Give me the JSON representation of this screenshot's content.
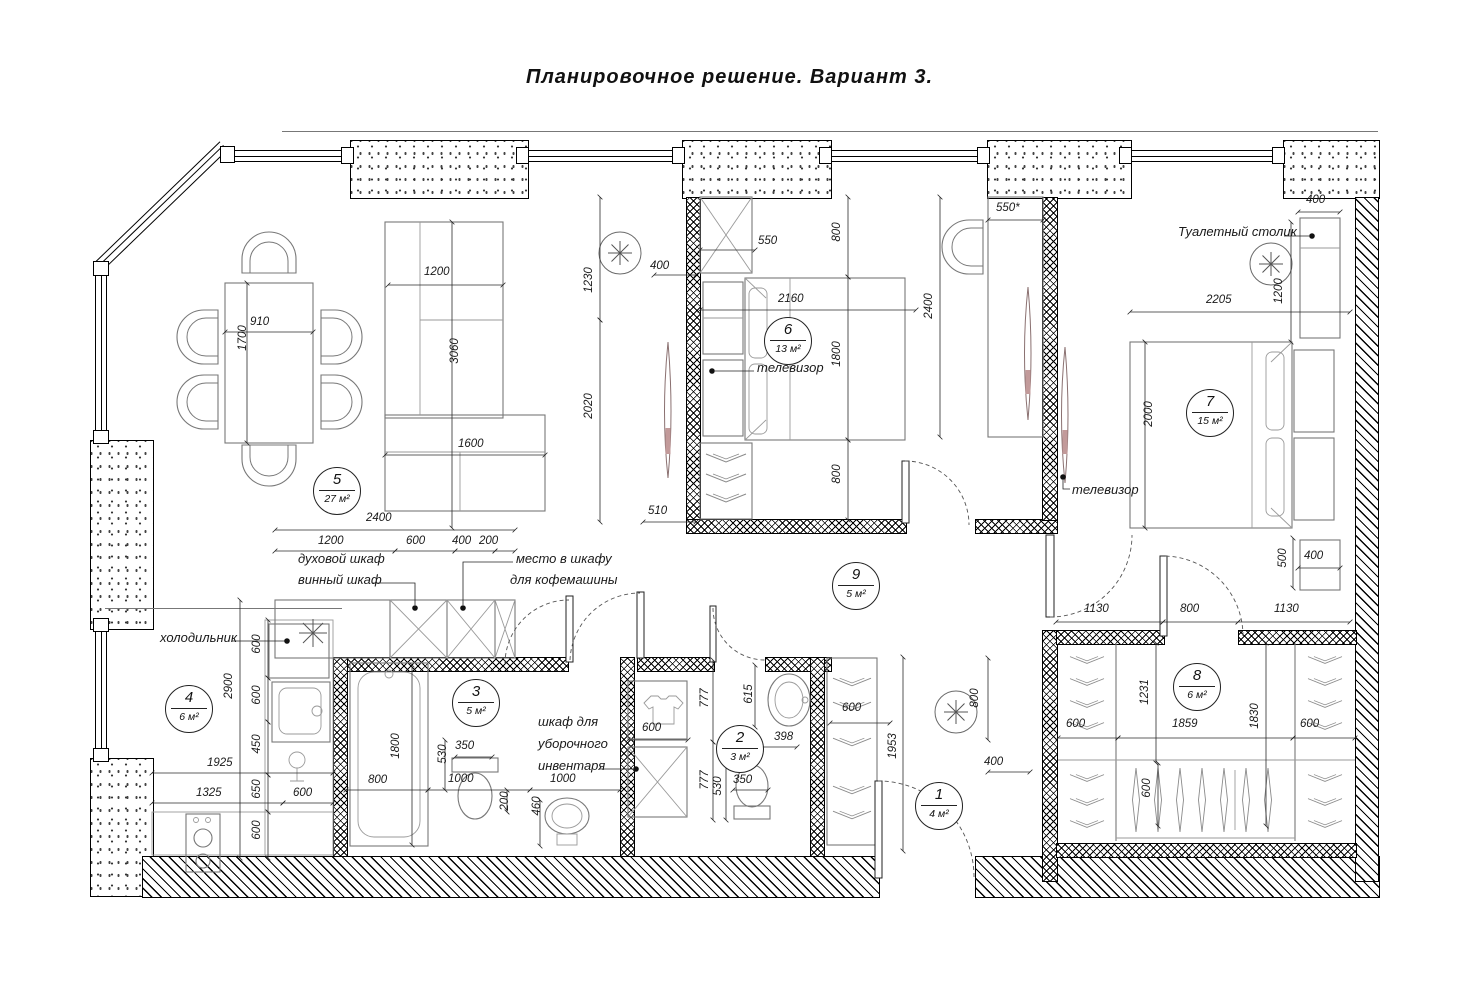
{
  "title": "Планировочное решение. Вариант 3.",
  "rooms": [
    {
      "num": "1",
      "area": "4 м²"
    },
    {
      "num": "2",
      "area": "3 м²"
    },
    {
      "num": "3",
      "area": "5 м²"
    },
    {
      "num": "4",
      "area": "6 м²"
    },
    {
      "num": "5",
      "area": "27 м²"
    },
    {
      "num": "6",
      "area": "13 м²"
    },
    {
      "num": "7",
      "area": "15 м²"
    },
    {
      "num": "8",
      "area": "6 м²"
    },
    {
      "num": "9",
      "area": "5 м²"
    }
  ],
  "labels": {
    "tv6": "телевизор",
    "tv7": "телевизор",
    "fridge": "холодильник",
    "oven": "духовой шкаф",
    "wine": "винный шкаф",
    "coffee1": "место в шкафу",
    "coffee2": "для кофемашины",
    "cleaning1": "шкаф для",
    "cleaning2": "уборочного",
    "cleaning3": "инвентаря",
    "vanity": "Туалетный столик"
  },
  "dims": [
    "910",
    "1700",
    "1200",
    "3060",
    "1600",
    "2400",
    "1200",
    "600",
    "400",
    "200",
    "600",
    "600",
    "450",
    "650",
    "600",
    "2900",
    "1925",
    "1325",
    "600",
    "1800",
    "800",
    "530",
    "350",
    "1000",
    "200",
    "460",
    "1000",
    "600",
    "777",
    "777",
    "615",
    "398",
    "350",
    "530",
    "550",
    "800",
    "400",
    "2160",
    "1800",
    "800",
    "1230",
    "2020",
    "510",
    "550*",
    "2400",
    "400",
    "1200",
    "2205",
    "2000",
    "500",
    "400",
    "1130",
    "800",
    "1130",
    "1231",
    "600",
    "1859",
    "1830",
    "600",
    "600",
    "600",
    "1953",
    "800",
    "400"
  ]
}
